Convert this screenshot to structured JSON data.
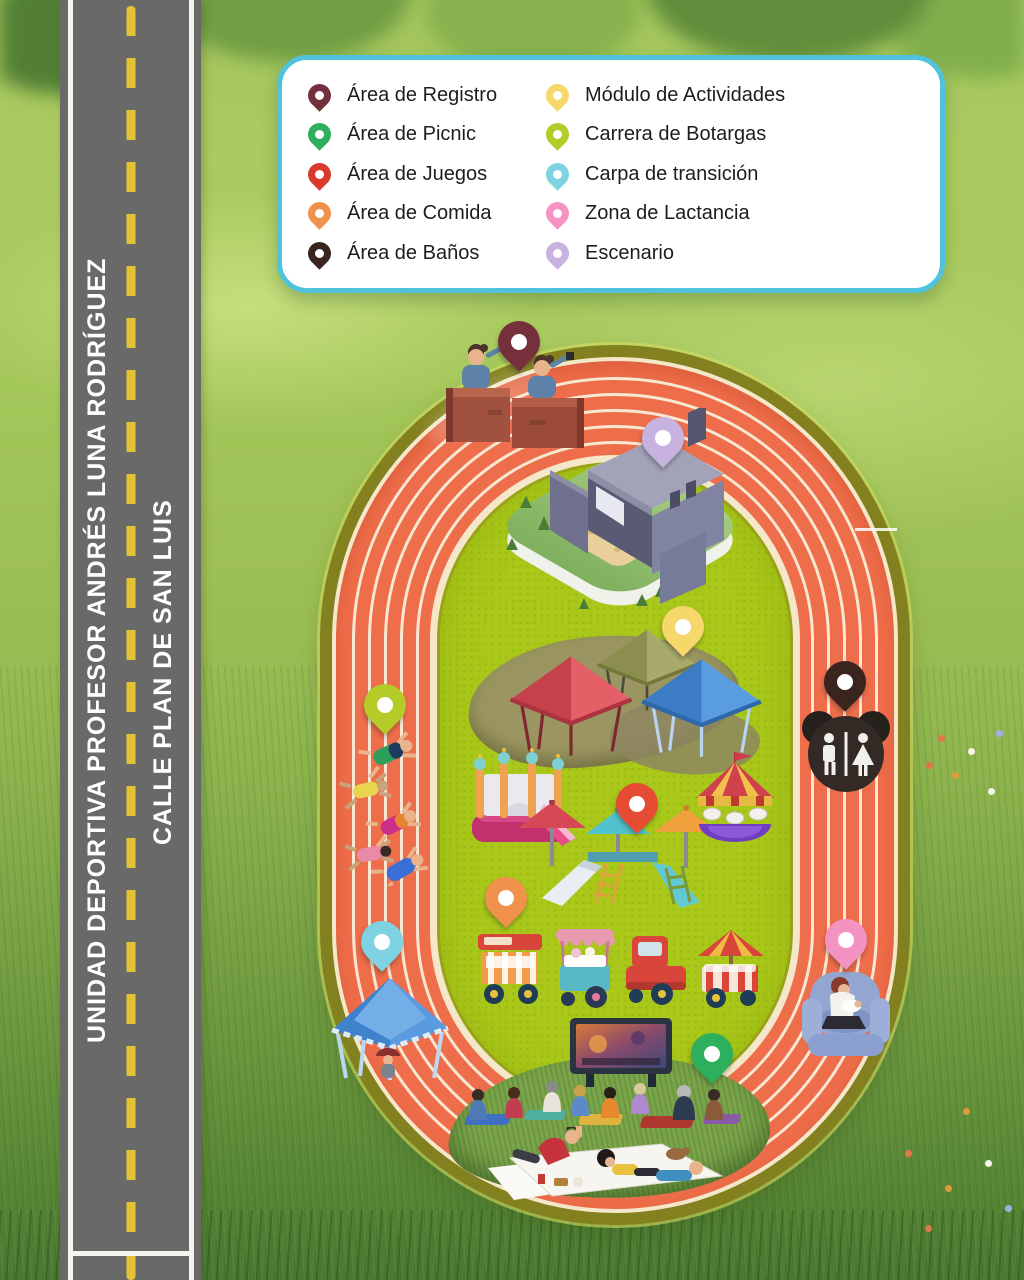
{
  "legend": {
    "border_color": "#4FC3DB",
    "items_left": [
      {
        "id": "area-registro",
        "label": "Área de Registro",
        "color": "#76303C"
      },
      {
        "id": "area-picnic",
        "label": "Área de Picnic",
        "color": "#2EAF5D"
      },
      {
        "id": "area-juegos",
        "label": "Área de Juegos",
        "color": "#D93A2B"
      },
      {
        "id": "area-comida",
        "label": "Área de Comida",
        "color": "#F0914C"
      },
      {
        "id": "area-banos",
        "label": "Área de Baños",
        "color": "#39241E"
      }
    ],
    "items_right": [
      {
        "id": "modulo-actividades",
        "label": "Módulo de Actividades",
        "color": "#F6D76A"
      },
      {
        "id": "carrera-botargas",
        "label": "Carrera de Botargas",
        "color": "#B5CC28"
      },
      {
        "id": "carpa-transicion",
        "label": "Carpa de transición",
        "color": "#7FD2E2"
      },
      {
        "id": "zona-lactancia",
        "label": "Zona de Lactancia",
        "color": "#F492C2"
      },
      {
        "id": "escenario",
        "label": "Escenario",
        "color": "#C8B2DF"
      }
    ]
  },
  "streets": {
    "facility_street": "UNIDAD DEPORTIVA PROFESOR ANDRÉS LUNA RODRÍGUEZ",
    "side_street": "CALLE PLAN DE SAN LUIS"
  },
  "map_markers": [
    {
      "id": "registro",
      "color": "#76303C",
      "x": 519,
      "y": 372
    },
    {
      "id": "escenario",
      "color": "#C8B2DF",
      "x": 663,
      "y": 468
    },
    {
      "id": "modulo-actividades",
      "color": "#F6D76A",
      "x": 683,
      "y": 657
    },
    {
      "id": "banos",
      "color": "#39241E",
      "x": 845,
      "y": 712
    },
    {
      "id": "juegos",
      "color": "#E64B33",
      "x": 637,
      "y": 834
    },
    {
      "id": "comida",
      "color": "#F0914C",
      "x": 506,
      "y": 928
    },
    {
      "id": "botargas",
      "color": "#B5CC28",
      "x": 385,
      "y": 735
    },
    {
      "id": "carpa-transicion",
      "color": "#7FD2E2",
      "x": 382,
      "y": 972
    },
    {
      "id": "lactancia",
      "color": "#F492C2",
      "x": 846,
      "y": 970
    },
    {
      "id": "picnic",
      "color": "#2EAF5D",
      "x": 712,
      "y": 1084
    }
  ],
  "track_colors": {
    "surface": "#EE6D4A",
    "lane_lines": "#F5E7C9",
    "border": "#83811F",
    "infield": "#AAC819"
  }
}
